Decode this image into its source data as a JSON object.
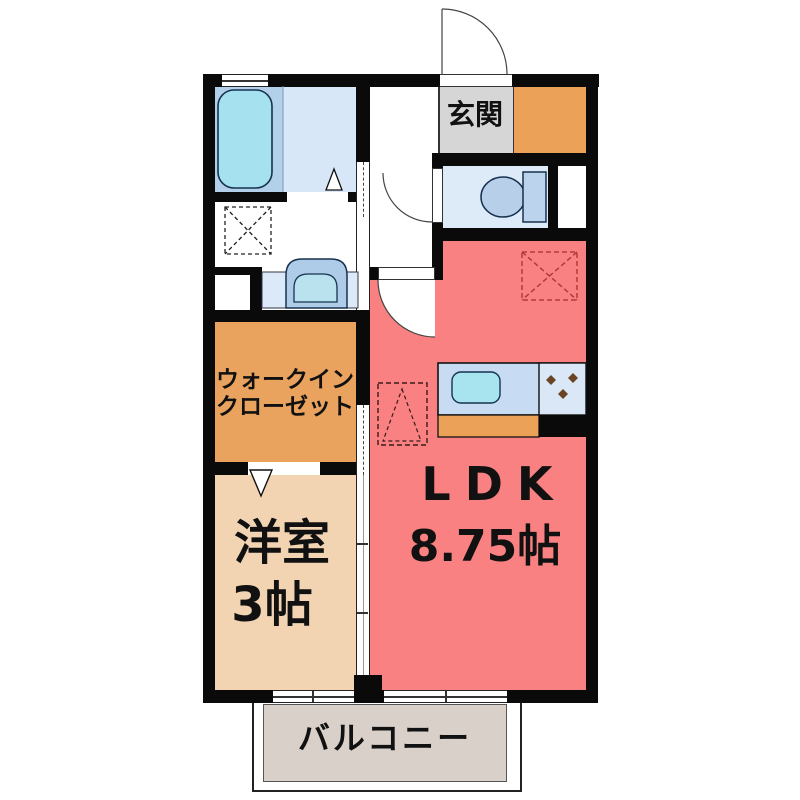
{
  "plan": {
    "labels": {
      "entrance": "玄関",
      "walkin_line1": "ウォークイン",
      "walkin_line2": "クローゼット",
      "western_room_name": "洋室",
      "western_room_size": "3帖",
      "ldk_name": "LDK",
      "ldk_size": "8.75帖",
      "balcony": "バルコニー"
    },
    "colors": {
      "wall": "#0a0a0a",
      "ldk": "#fa8181",
      "western_room": "#f3d4b2",
      "closet": "#e9a35e",
      "shoe_cabinet": "#eca159",
      "entrance_tile": "#d6d6d6",
      "bath_floor": "#b3d0ea",
      "bath_floor_light": "#d7e7f7",
      "toilet_floor": "#ddebf8",
      "counter_blue": "#c7dbf2",
      "stove_top_blue": "#dae7f6",
      "fixture_blue": "#aecbe8",
      "water_cyan": "#a5e1ef",
      "balcony_floor": "#d9d1c9",
      "dashed_red": "#b43a3a",
      "stove_dot_brown": "#6b4423"
    },
    "fixtures": [
      "bathtub",
      "washbasin",
      "washing-machine-space",
      "toilet",
      "kitchen-sink",
      "gas-stove",
      "refrigerator-space",
      "equipment-space",
      "entrance-door",
      "sliding-doors"
    ]
  }
}
